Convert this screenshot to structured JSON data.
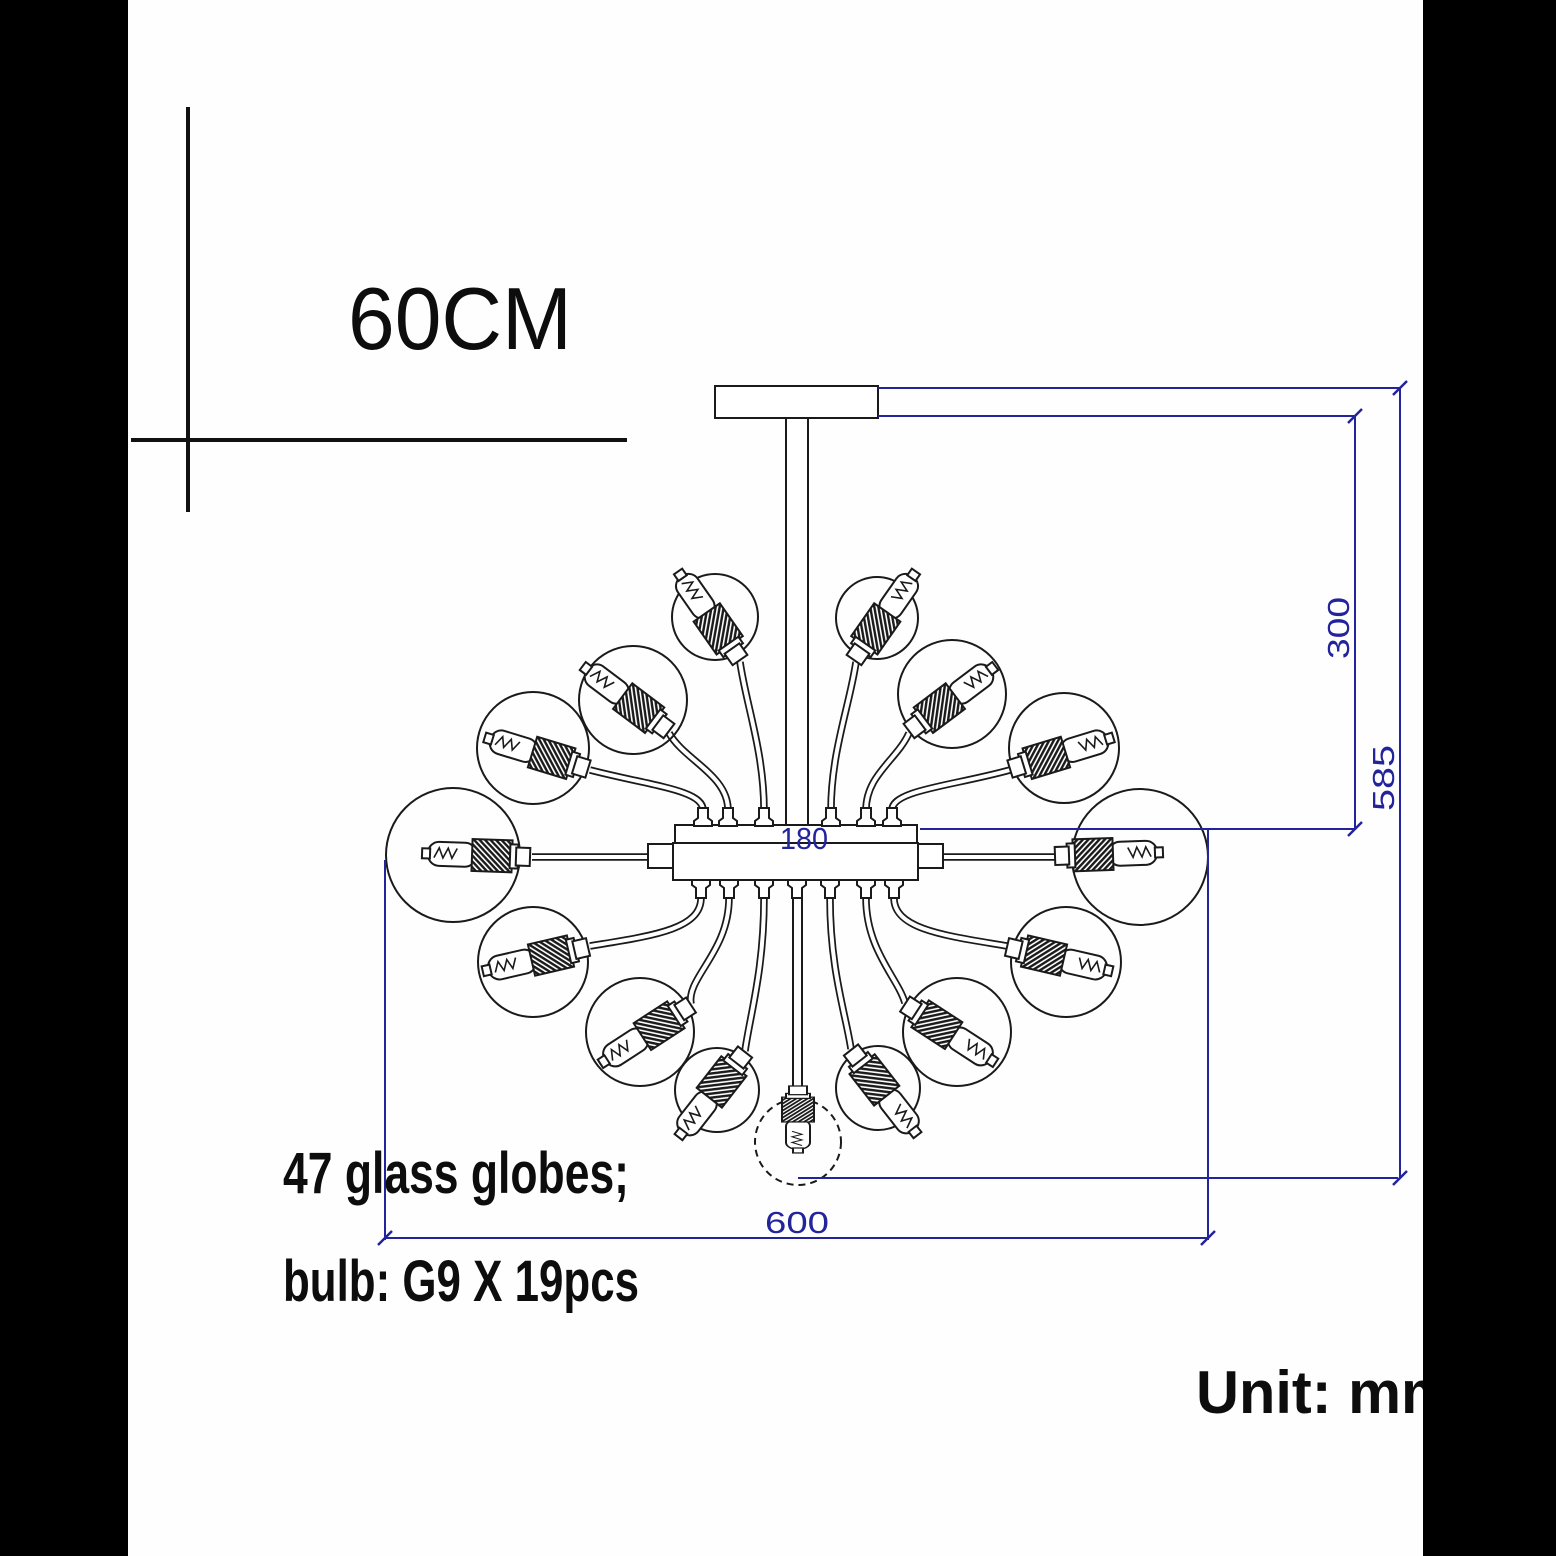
{
  "labels": {
    "size_marker": "60CM",
    "globes_note": "47 glass globes;",
    "bulb_note": "bulb: G9 X 19pcs",
    "unit_note": "Unit: mm"
  },
  "dimensions": {
    "drop_height": "300",
    "total_height": "585",
    "width": "600",
    "hub_length": "180"
  },
  "colors": {
    "dimension_line": "#23239b",
    "drawing_line": "#1a1a1a",
    "background": "#fefefe",
    "matte": "#000000"
  }
}
